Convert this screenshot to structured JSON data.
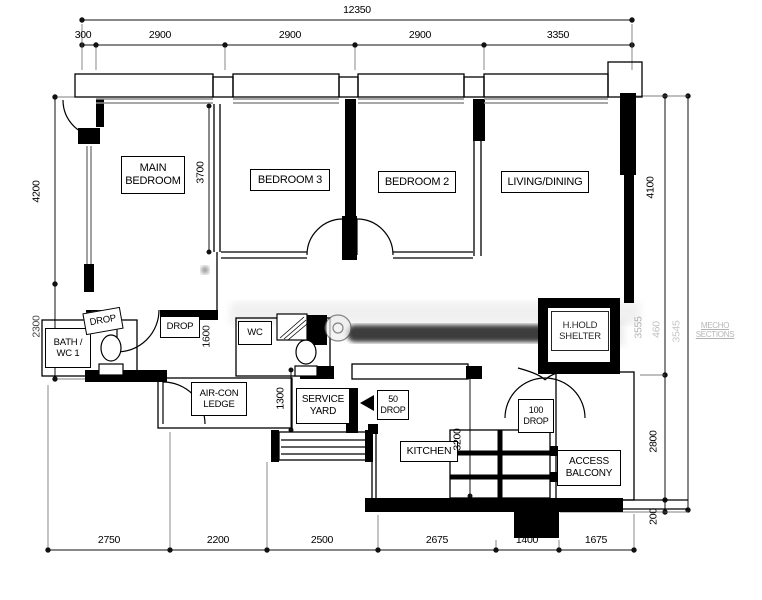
{
  "rooms": {
    "main_bedroom": "MAIN\nBEDROOM",
    "bedroom3": "BEDROOM 3",
    "bedroom2": "BEDROOM 2",
    "living_dining": "LIVING/DINING",
    "bath_wc1": "BATH /\nWC 1",
    "wc2": "WC",
    "household_shelter": "H.HOLD\nSHELTER",
    "aircon_ledge": "AIR-CON\nLEDGE",
    "service_yard": "SERVICE\nYARD",
    "kitchen": "KITCHEN",
    "access_balcony": "ACCESS\nBALCONY"
  },
  "annotations": {
    "drop_bath": "DROP",
    "drop_hall": "DROP",
    "drop_service": "50\nDROP",
    "drop_shelter": "100\nDROP"
  },
  "dims": {
    "top_total": "12350",
    "top": [
      "300",
      "2900",
      "2900",
      "2900",
      "3350"
    ],
    "bottom": [
      "2750",
      "2200",
      "2500",
      "2675",
      "1400",
      "1675"
    ],
    "left": [
      "4200",
      "2300"
    ],
    "right": [
      "4100",
      "2800",
      "200"
    ],
    "interior": {
      "bedrooms_depth": "3700",
      "hallway": "1600",
      "service_yard": "1300",
      "kitchen_depth": "3200"
    }
  },
  "watermark": {
    "faded_right_rotated": [
      "3555",
      "460",
      "3545"
    ],
    "faded_right_text": "MECHO\nSECTIONS"
  }
}
